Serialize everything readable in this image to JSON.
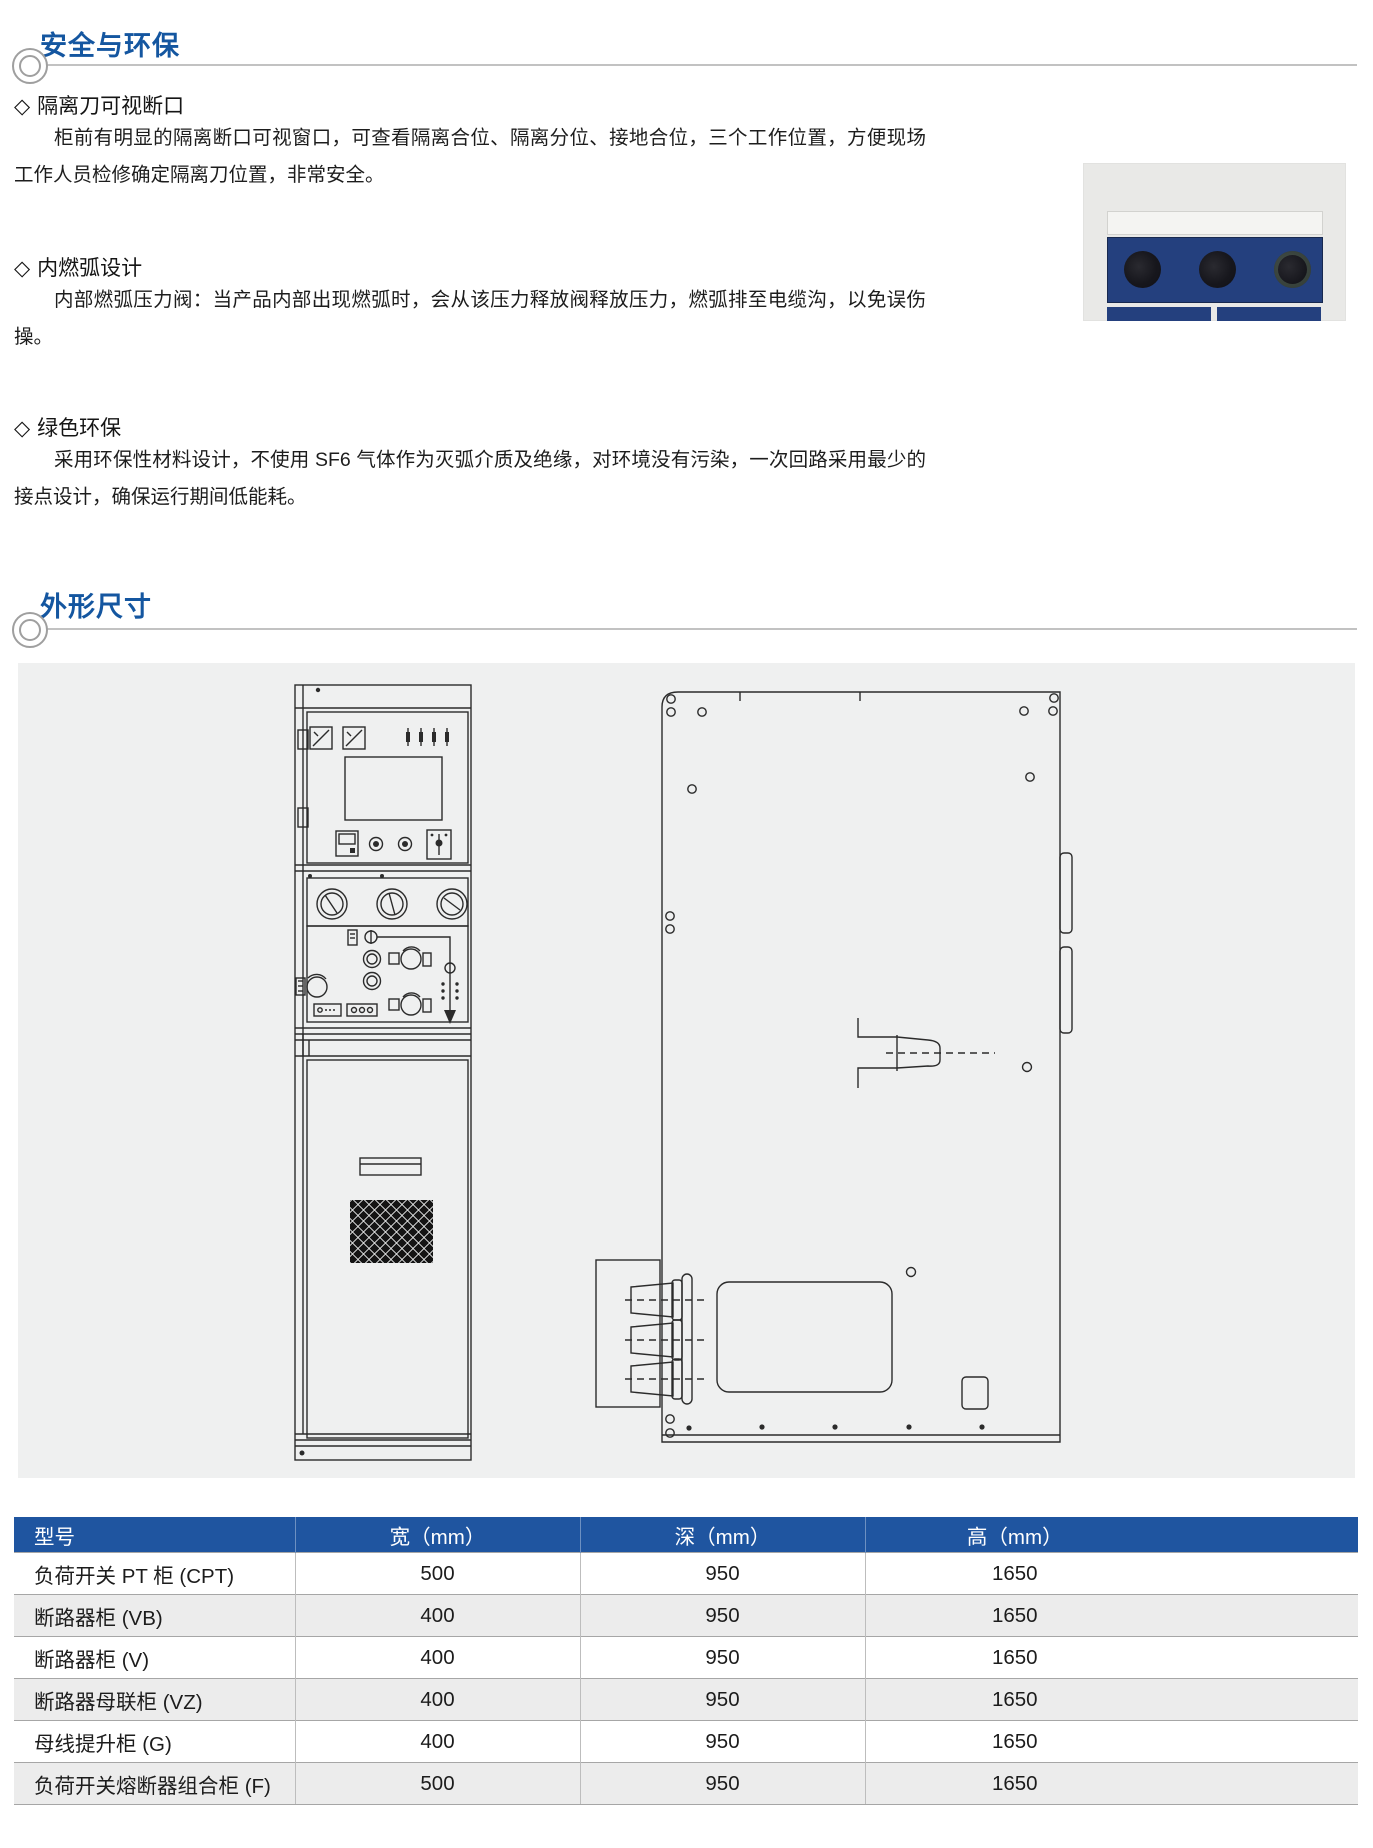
{
  "ui": {
    "diamond": "◇"
  },
  "sections": {
    "safety": {
      "title": "安全与环保",
      "items": [
        {
          "heading": "隔离刀可视断口",
          "body": "柜前有明显的隔离断口可视窗口，可查看隔离合位、隔离分位、接地合位，三个工作位置，方便现场工作人员检修确定隔离刀位置，非常安全。"
        },
        {
          "heading": "内燃弧设计",
          "body": "内部燃弧压力阀：当产品内部出现燃弧时，会从该压力释放阀释放压力，燃弧排至电缆沟，以免误伤操。"
        },
        {
          "heading": "绿色环保",
          "body": "采用环保性材料设计，不使用 SF6 气体作为灭弧介质及绝缘，对环境没有污染，一次回路采用最少的接点设计，确保运行期间低能耗。"
        }
      ]
    },
    "dimensions": {
      "title": "外形尺寸"
    }
  },
  "photo": {
    "description": "隔离断口可视窗口照片",
    "navy": "#24407E"
  },
  "drawings": {
    "front_view": "cabinet-front-view",
    "side_view": "cabinet-side-view"
  },
  "dimensions_table": {
    "columns": [
      "型号",
      "宽（mm）",
      "深（mm）",
      "高（mm）"
    ],
    "rows": [
      [
        "负荷开关 PT 柜 (CPT)",
        "500",
        "950",
        "1650"
      ],
      [
        "断路器柜 (VB)",
        "400",
        "950",
        "1650"
      ],
      [
        "断路器柜 (V)",
        "400",
        "950",
        "1650"
      ],
      [
        "断路器母联柜 (VZ)",
        "400",
        "950",
        "1650"
      ],
      [
        "母线提升柜 (G)",
        "400",
        "950",
        "1650"
      ],
      [
        "负荷开关熔断器组合柜 (F)",
        "500",
        "950",
        "1650"
      ]
    ]
  },
  "colors": {
    "accent_blue": "#1456A0",
    "table_header_blue": "#1F55A0",
    "drawing_bg": "#EFF0F0",
    "photo_navy": "#24407E"
  }
}
